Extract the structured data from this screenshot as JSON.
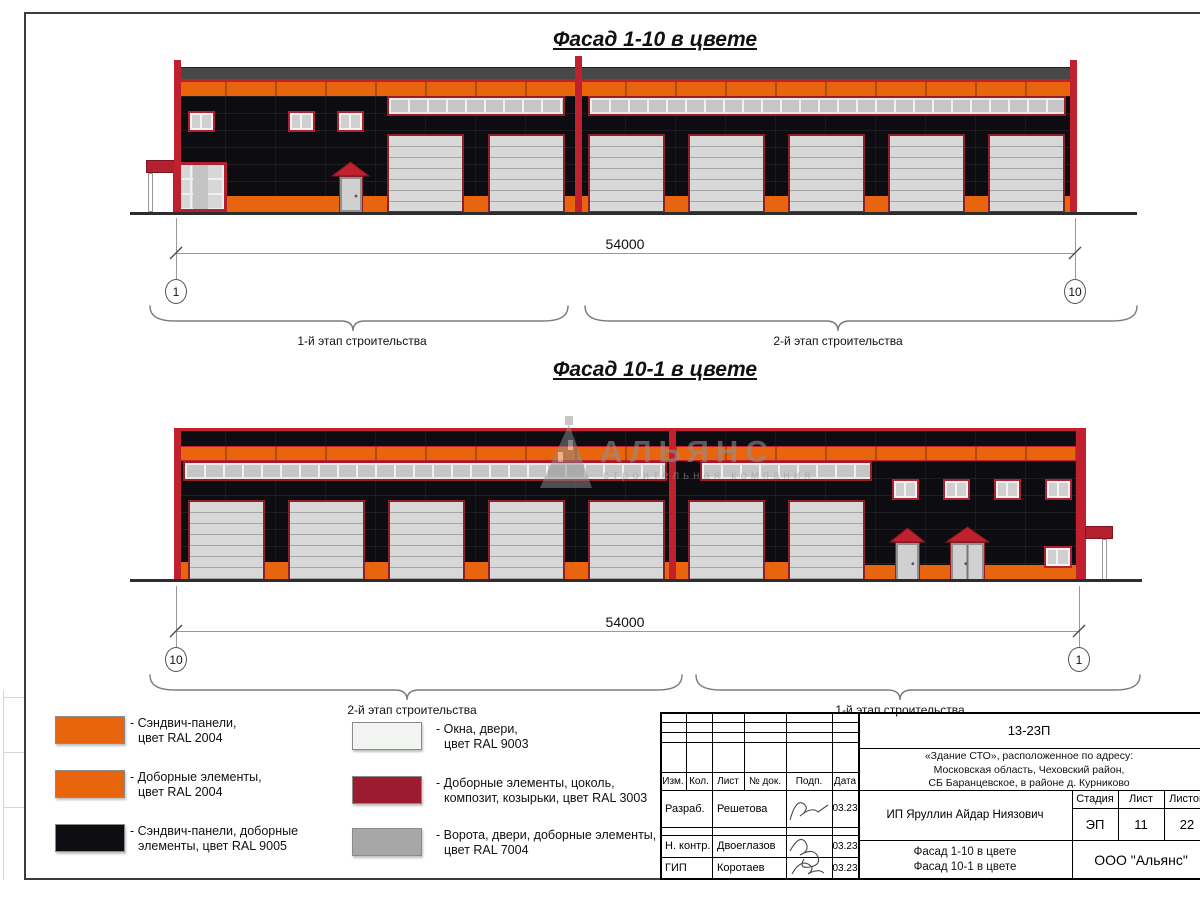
{
  "facades": {
    "f1": {
      "title": "Фасад 1-10 в цвете",
      "dim": "54000",
      "axisL": "1",
      "axisR": "10",
      "braceL": "1-й этап строительства",
      "braceR": "2-й этап строительства"
    },
    "f2": {
      "title": "Фасад 10-1 в цвете",
      "dim": "54000",
      "axisL": "10",
      "axisR": "1",
      "braceL": "2-й этап строительства",
      "braceR": "1-й этап строительства"
    }
  },
  "watermark": {
    "title": "АЛЬЯНС",
    "subtitle": "строительная компания"
  },
  "legend": {
    "items": [
      {
        "swatch": "#e8650d",
        "line1": "- Сэндвич-панели,",
        "line2": "цвет RAL 2004"
      },
      {
        "swatch": "#e8650d",
        "line1": "- Доборные элементы,",
        "line2": "цвет RAL 2004"
      },
      {
        "swatch": "#0d0d12",
        "line1": "- Сэндвич-панели, доборные",
        "line2": "элементы, цвет RAL 9005"
      },
      {
        "swatch": "#f2f4f1",
        "line1": "- Окна, двери,",
        "line2": "цвет RAL 9003"
      },
      {
        "swatch": "#9c1b2e",
        "line1": "- Доборные элементы, цоколь,",
        "line2": "композит, козырьки, цвет RAL 3003"
      },
      {
        "swatch": "#a7a7a7",
        "line1": "- Ворота, двери, доборные элементы,",
        "line2": "цвет RAL 7004"
      }
    ]
  },
  "titleblock": {
    "doc_number": "13-23П",
    "project_line1": "«Здание СТО», расположенное по адресу:",
    "project_line2": "Московская область, Чеховский район,",
    "project_line3": "СБ Баранцевское, в районе д. Курниково",
    "client": "ИП Яруллин Айдар Ниязович",
    "col_izm": "Изм.",
    "col_kol": "Кол.",
    "col_list": "Лист",
    "col_doc": "№ док.",
    "col_podp": "Подп.",
    "col_data": "Дата",
    "row1_role": "Разраб.",
    "row1_name": "Решетова",
    "row1_date": "03.23",
    "row2_role": "Н. контр.",
    "row2_name": "Двоеглазов",
    "row2_date": "03.23",
    "row3_role": "ГИП",
    "row3_name": "Коротаев",
    "row3_date": "03.23",
    "stage_label": "Стадия",
    "list_label": "Лист",
    "listov_label": "Листов",
    "stage_value": "ЭП",
    "list_value": "11",
    "listov_value": "22",
    "sheet_title1": "Фасад 1-10 в цвете",
    "sheet_title2": "Фасад 10-1 в цвете",
    "company": "ООО \"Альянс\""
  },
  "colors": {
    "orange_ral2004": "#e8650d",
    "black_ral9005": "#0d0d12",
    "red_ral3003": "#9c1b2e",
    "trim_red": "#c1202f",
    "white_ral9003": "#f2f4f1",
    "grey_ral7004": "#a7a7a7",
    "roof_grey": "#484848"
  }
}
